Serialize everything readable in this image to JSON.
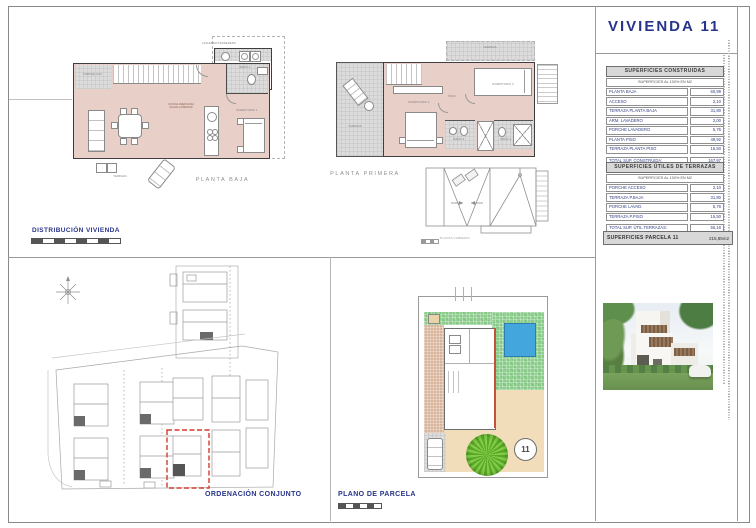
{
  "sheet": {
    "title": "VIVIENDA 11"
  },
  "section_labels": {
    "distribucion": "DISTRIBUCIÓN VIVIENDA",
    "ordenacion": "ORDENACIÓN CONJUNTO",
    "plano_parcela": "PLANO DE PARCELA"
  },
  "plan_labels": {
    "planta_baja": "PLANTA BAJA",
    "planta_primera": "PLANTA PRIMERA",
    "planta_cubierta": "PLANTA CUBIERTA"
  },
  "room_labels": {
    "baja_lavadero": "LAVADERO/TENDEDERO",
    "baja_porche": "PORCHE ACC.",
    "baja_bano": "BAÑO 1",
    "baja_cocina_l1": "COCINA AMERICANA",
    "baja_cocina_l2": "SALON-COMEDOR",
    "baja_dormitorio": "DORMITORIO 1",
    "baja_terraza": "TERRAZA",
    "primera_terraza": "TERRAZA",
    "primera_terraza_sup": "TERRAZA",
    "primera_dormitorio2": "DORMITORIO 2",
    "primera_dormitorio3": "DORMITORIO 3",
    "primera_paso": "PASO",
    "primera_bano2": "BAÑO 2",
    "primera_bano3": "BAÑO 3"
  },
  "tables": {
    "construidas": {
      "title": "SUPERFICIES CONSTRUIDAS",
      "subtitle": "SUPERFICIES AL 100% EN M2",
      "rows": [
        {
          "label": "PLANTA BAJA",
          "value": "60,89"
        },
        {
          "label": "ACCESO",
          "value": "2,10"
        },
        {
          "label": "TERRAZA PLANTA BAJA",
          "value": "31,80"
        },
        {
          "label": "ARM. LAVADERO",
          "value": "2,00"
        },
        {
          "label": "PORCHE LAVADERO",
          "value": "5,76"
        },
        {
          "label": "PLANTA PISO",
          "value": "49,92"
        },
        {
          "label": "TERRAZA PLANTA PISO",
          "value": "15,50"
        }
      ],
      "total_label": "TOTAL SUP. CONSTRUIDA:",
      "total_value": "167,97"
    },
    "terrazas": {
      "title": "SUPERFICIES ÚTILES DE TERRAZAS",
      "subtitle": "SUPERFICIES AL 100% EN M2",
      "rows": [
        {
          "label": "PORCHE ACCESO",
          "value": "2,10"
        },
        {
          "label": "TERRAZA P.BAJA",
          "value": "31,80"
        },
        {
          "label": "PORCHE LAVAD.",
          "value": "5,76"
        },
        {
          "label": "TERRAZA P.PISO",
          "value": "15,50"
        }
      ],
      "total_label": "TOTAL SUP. ÚTIL TERRAZAS:",
      "total_value": "55,16"
    },
    "parcela_bar": {
      "label": "SUPERFICIES PARCELA 11",
      "value": "215,85m2"
    }
  },
  "parcel": {
    "circle_number": "11"
  },
  "colors": {
    "accent_blue": "#27348b",
    "plan_fill": "#e8cfc8",
    "terrace_gray": "#dcdcdc",
    "pool_blue": "#43a6dc",
    "garden_green": "#8fcf8f",
    "highlight_red": "#d23a2e"
  }
}
